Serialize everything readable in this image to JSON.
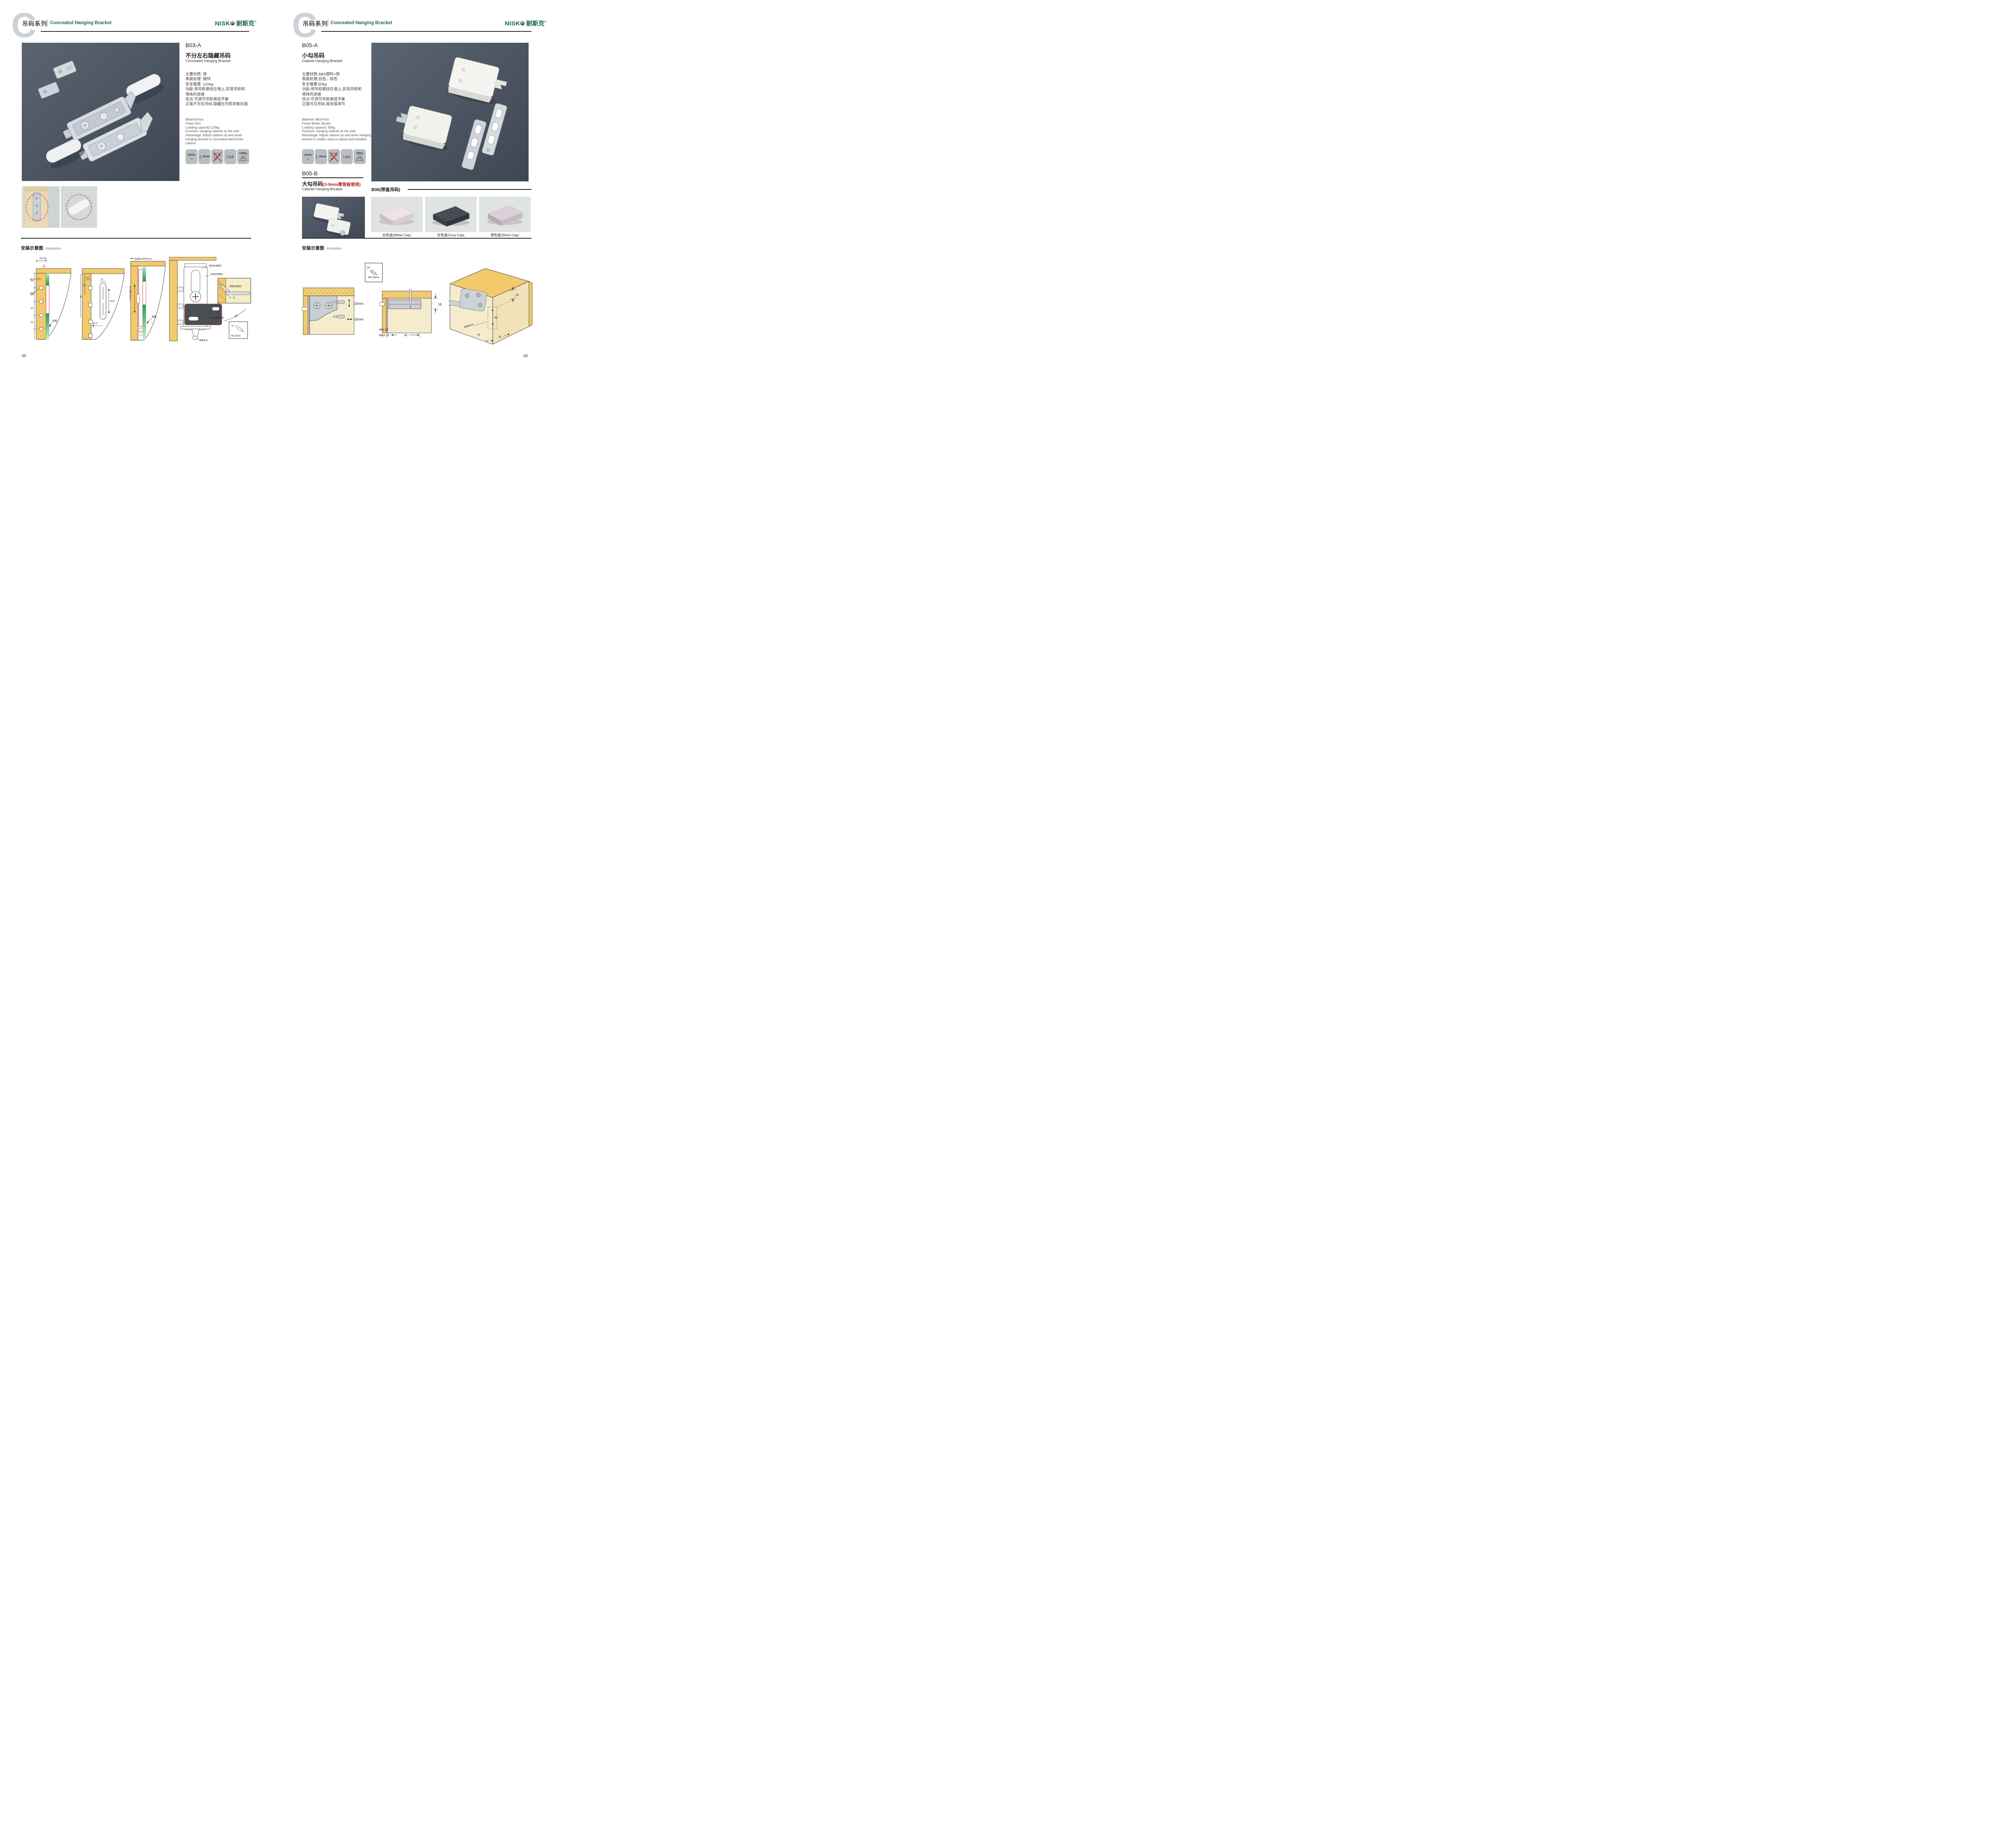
{
  "header": {
    "watermark": "C",
    "series_cn": "吊码系列",
    "series_en": "Concealed Hanging Bracket"
  },
  "brand": {
    "latin": "NISKO",
    "cn": "耐斯克",
    "reg": "®"
  },
  "left": {
    "product": {
      "code": "B03-A",
      "title_cn": "不分左右隐藏吊码",
      "title_en": "Concealed Hanging Bracket",
      "specs_cn": [
        "主要材质: 铁",
        "表面处理: 镀锌",
        "安全载重: 120kg",
        "功能:将吊柜悬挂在墙上,实现吊柜和",
        "墙体的连接",
        "优点:可调节吊柜高低平衡",
        "正面不可见吊码,隐藏在吊柜背板后面"
      ],
      "specs_en": [
        "Material:Iron",
        "Finish:Zinc",
        "Loading capacity:120kg",
        "Function: hanging cabinet on the wall",
        "Advantage: Adjust cabinet up and down",
        "hanging bracket is concealed behind the cabinet"
      ],
      "icons": {
        "width": "10mm",
        "height": "10mm",
        "lga": "LGA",
        "load": "120Kg"
      }
    },
    "install": {
      "title_cn": "安装示意图",
      "title_en": "Installation",
      "d1": {
        "dim_top": "16-18",
        "dim_offset": "5",
        "dim_v1": "35",
        "dim_v2": "32",
        "dim_v3": "32",
        "dim_v4": "32",
        "label_holes": "Φ3.0-4个沉孔",
        "label_even": "均布",
        "label_back": "背板"
      },
      "d2": {
        "dim_v1": "60",
        "dim_v2": "35",
        "dim_w1": "12.5",
        "dim_w2": "12",
        "dim_h1": "42.5",
        "dim_w3": "20.5"
      },
      "d3": {
        "label_top": "前后最大调节10mm",
        "label_side": "上下调节10mm",
        "label_back": "背板"
      },
      "d4": {
        "label_screw1": "安装自攻螺丝",
        "label_screw2": "安装自攻螺丝",
        "label_plate": "专用挂片",
        "label_screw3": "安装自攻螺丝",
        "label_lock": "锁紧状态",
        "inset_screw": "安装自攻螺丝",
        "inset_angle": "45°",
        "inset_qty": "1x",
        "inset_dia": "Φ3.5mm"
      }
    },
    "page_number": "65"
  },
  "right": {
    "b05a": {
      "code": "B05-A",
      "title_cn": "小勾吊码",
      "title_en": "Cabinet Hanging Bracket",
      "specs_cn": [
        "主要材质:ABS塑料+铁",
        "表面处理:白色、棕色",
        "安全载重:60kg",
        "功能:将吊柜悬挂在墙上,实现吊柜和",
        "墙体的连接",
        "优点:可调节吊柜高低平衡",
        "正面可见吊码,易安装调节"
      ],
      "specs_en": [
        "Material: ABS+Iron",
        "Finish:White, Brown",
        "Loading capacity: 60kg",
        "Function: hanging cabinet on the wall",
        "Advantage: Adjust cabinet up and down hanging",
        "bracket is visible, easy to adjust and installed"
      ],
      "icons": {
        "width": "15mm",
        "height": "10mm",
        "lga": "LGA",
        "load": "60Kg"
      }
    },
    "b05b": {
      "code": "B05-B",
      "title_cn": "大勾吊码",
      "title_note": "(3-9mm厚背板使用)",
      "title_en": "Cabinet Hanging Brcaket"
    },
    "b06": {
      "label": "B06(带盖吊码)",
      "cap1": "白色盖(White Cap)",
      "cap2": "灰色盖(Gray Cap)",
      "cap3": "银色盖(Silver Cap)"
    },
    "install": {
      "title_cn": "安装示意图",
      "title_en": "Installation",
      "screwbox": {
        "qty": "2x",
        "dia": "Φ4×30mm"
      },
      "r1": {
        "dim_v": "10mm",
        "dim_h": "15mm"
      },
      "r2": {
        "dim_18": "18",
        "dim_min": "MIN.10",
        "dim_max": "MAX.23",
        "dim_58": "58"
      },
      "r3": {
        "dim_16t": "16",
        "dim_42": "42",
        "dim_r": "RMAX4",
        "dim_16b": "16",
        "dim_17": "17",
        "dim_32": "32"
      }
    },
    "page_number": "66"
  }
}
